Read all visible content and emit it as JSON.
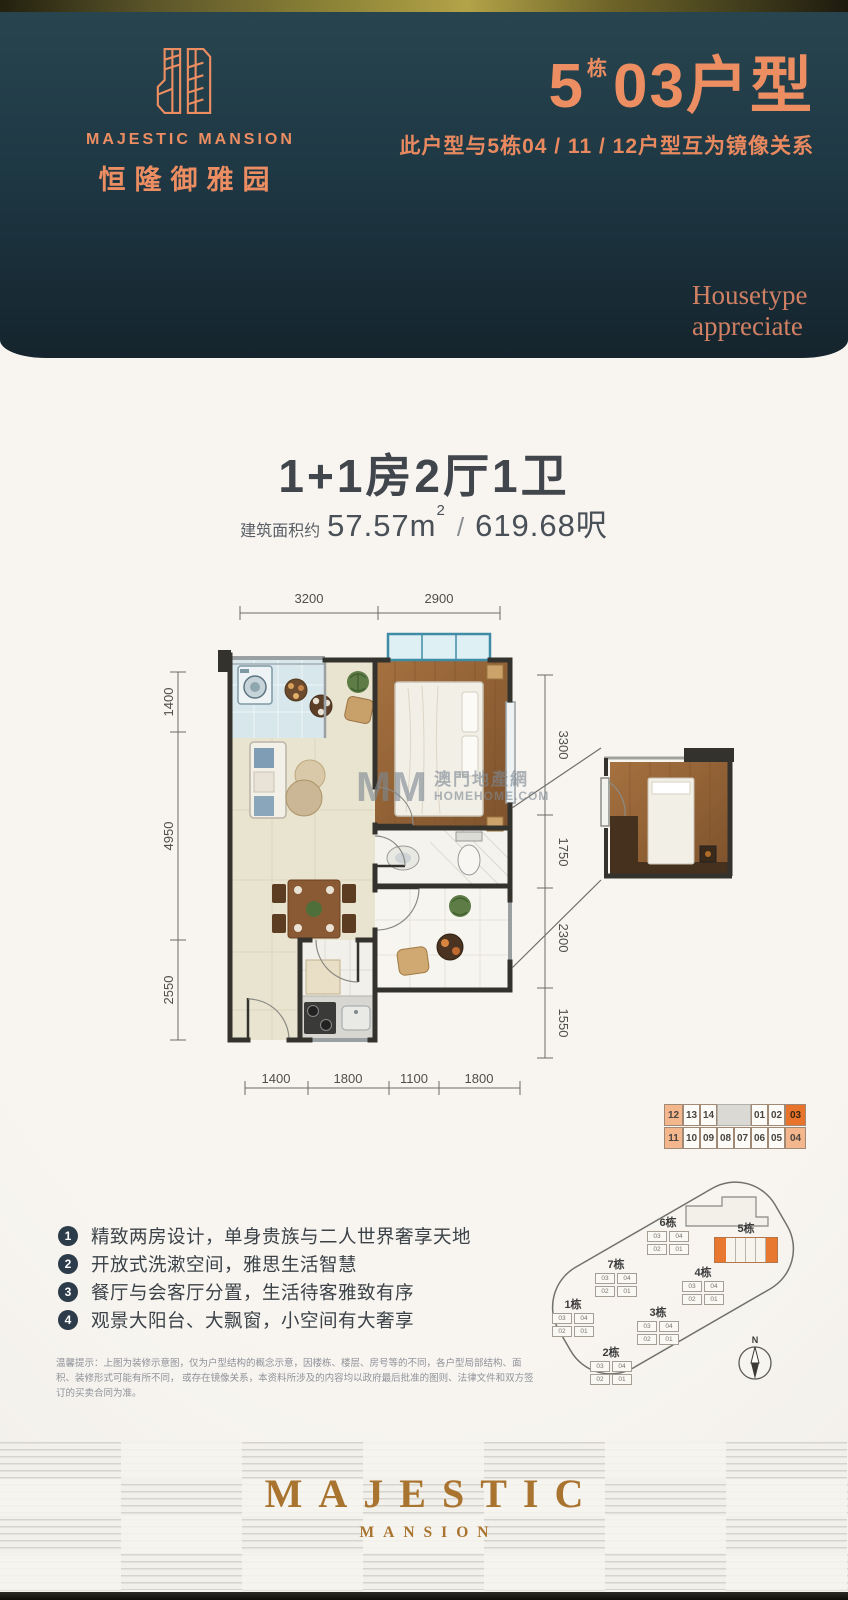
{
  "header": {
    "brand_en": "MAJESTIC MANSION",
    "brand_cn": "恒隆御雅园",
    "unit_block": "5",
    "unit_block_suffix": "栋",
    "unit_name": "03户型",
    "mirror_note": "此户型与5栋04 / 11 / 12户型互为镜像关系",
    "tagline_line1": "Housetype",
    "tagline_line2": "appreciate"
  },
  "summary": {
    "layout_title": "1+1房2厅1卫",
    "area_prefix": "建筑面积约",
    "area_value": "57.57m",
    "area_sup": "2",
    "area_sep": "/",
    "area_ft": "619.68呎"
  },
  "floorplan": {
    "dims_top": [
      "3200",
      "2900"
    ],
    "dims_left": [
      "1400",
      "4950",
      "2550"
    ],
    "dims_right": [
      "3300",
      "1750",
      "2300",
      "1550"
    ],
    "dims_bottom": [
      "1400",
      "1800",
      "1100",
      "1800"
    ],
    "watermark_mm": "MM",
    "watermark_cn": "澳門地產網",
    "watermark_site": "HOMEHOME.COM"
  },
  "floor_strip": {
    "top_row": [
      "12",
      "13",
      "14",
      "01",
      "02",
      "03"
    ],
    "bottom_row": [
      "11",
      "10",
      "09",
      "08",
      "07",
      "06",
      "05",
      "04"
    ],
    "highlight_unit": "03"
  },
  "features": [
    {
      "num": "1",
      "text": "精致两房设计，单身贵族与二人世界奢享天地"
    },
    {
      "num": "2",
      "text": "开放式洗漱空间，雅思生活智慧"
    },
    {
      "num": "3",
      "text": "餐厅与会客厅分置，生活待客雅致有序"
    },
    {
      "num": "4",
      "text": "观景大阳台、大飘窗，小空间有大奢享"
    }
  ],
  "siteplan": {
    "buildings": [
      {
        "label": "1栋"
      },
      {
        "label": "2栋"
      },
      {
        "label": "3栋"
      },
      {
        "label": "4栋"
      },
      {
        "label": "6栋"
      },
      {
        "label": "7栋"
      }
    ],
    "highlight_building": "5栋",
    "cell_labels": [
      "03",
      "04",
      "02",
      "01"
    ],
    "compass": "N"
  },
  "disclaimer": {
    "line1": "温馨提示：上图为装修示意图，仅为户型结构的概念示意，因楼栋、楼层、房号等的不同，各户型局部结构、面积、装修形式可能有所不同，",
    "line2": "或存在镜像关系，本资料所涉及的内容均以政府最后批准的图则、法律文件和双方签订的买卖合同为准。"
  },
  "footer": {
    "brand": "MAJESTIC",
    "sub_brand": "MANSION"
  },
  "colors": {
    "header_navy": "#1e3844",
    "accent_salmon": "#ec8d62",
    "highlight_orange": "#e8742c",
    "mirror_salmon": "#f4b68d",
    "bronze": "#a9742f"
  }
}
